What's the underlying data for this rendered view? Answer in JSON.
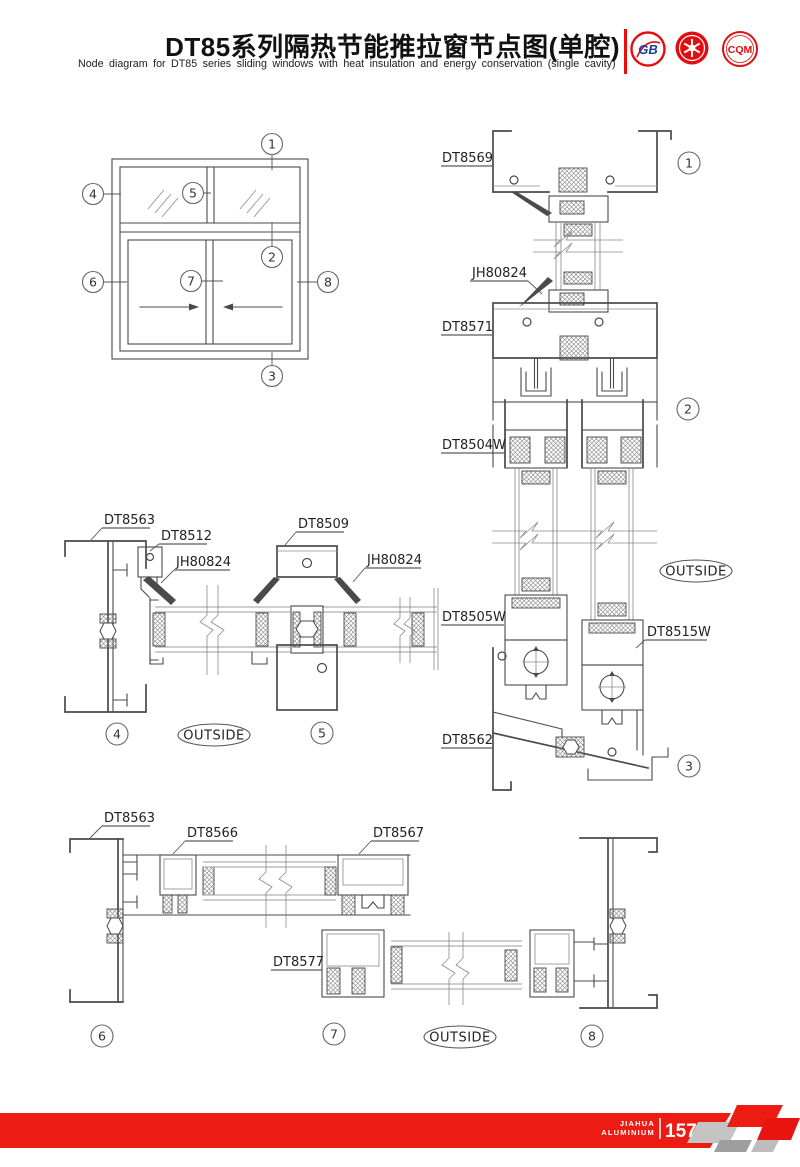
{
  "header": {
    "title": "DT85系列隔热节能推拉窗节点图(单腔)",
    "subtitle": "Node diagram for DT85 series sliding windows with heat insulation and energy conservation (single cavity)",
    "divider_color": "#e8100c",
    "logos": [
      {
        "name": "gb-certification-logo",
        "text": "GB"
      },
      {
        "name": "star-seal-logo",
        "text": ""
      },
      {
        "name": "cqm-certification-logo",
        "text": "CQM"
      }
    ]
  },
  "drawing": {
    "outside_label": "OUTSIDE",
    "callout_numbers": {
      "n1": "1",
      "n2": "2",
      "n3": "3",
      "n4": "4",
      "n5": "5",
      "n6": "6",
      "n7": "7",
      "n8": "8"
    },
    "profile_labels": {
      "dt8569": "DT8569",
      "jh80824": "JH80824",
      "dt8571": "DT8571",
      "dt8504w": "DT8504W",
      "dt8505w": "DT8505W",
      "dt8515w": "DT8515W",
      "dt8562": "DT8562",
      "dt8563": "DT8563",
      "dt8512": "DT8512",
      "dt8509": "DT8509",
      "dt8566": "DT8566",
      "dt8567": "DT8567",
      "dt8577": "DT8577"
    }
  },
  "footer": {
    "brand_line1": "JIAHUA",
    "brand_line2": "ALUMINIUM",
    "page_number": "157",
    "band_color": "#ed1c13"
  }
}
